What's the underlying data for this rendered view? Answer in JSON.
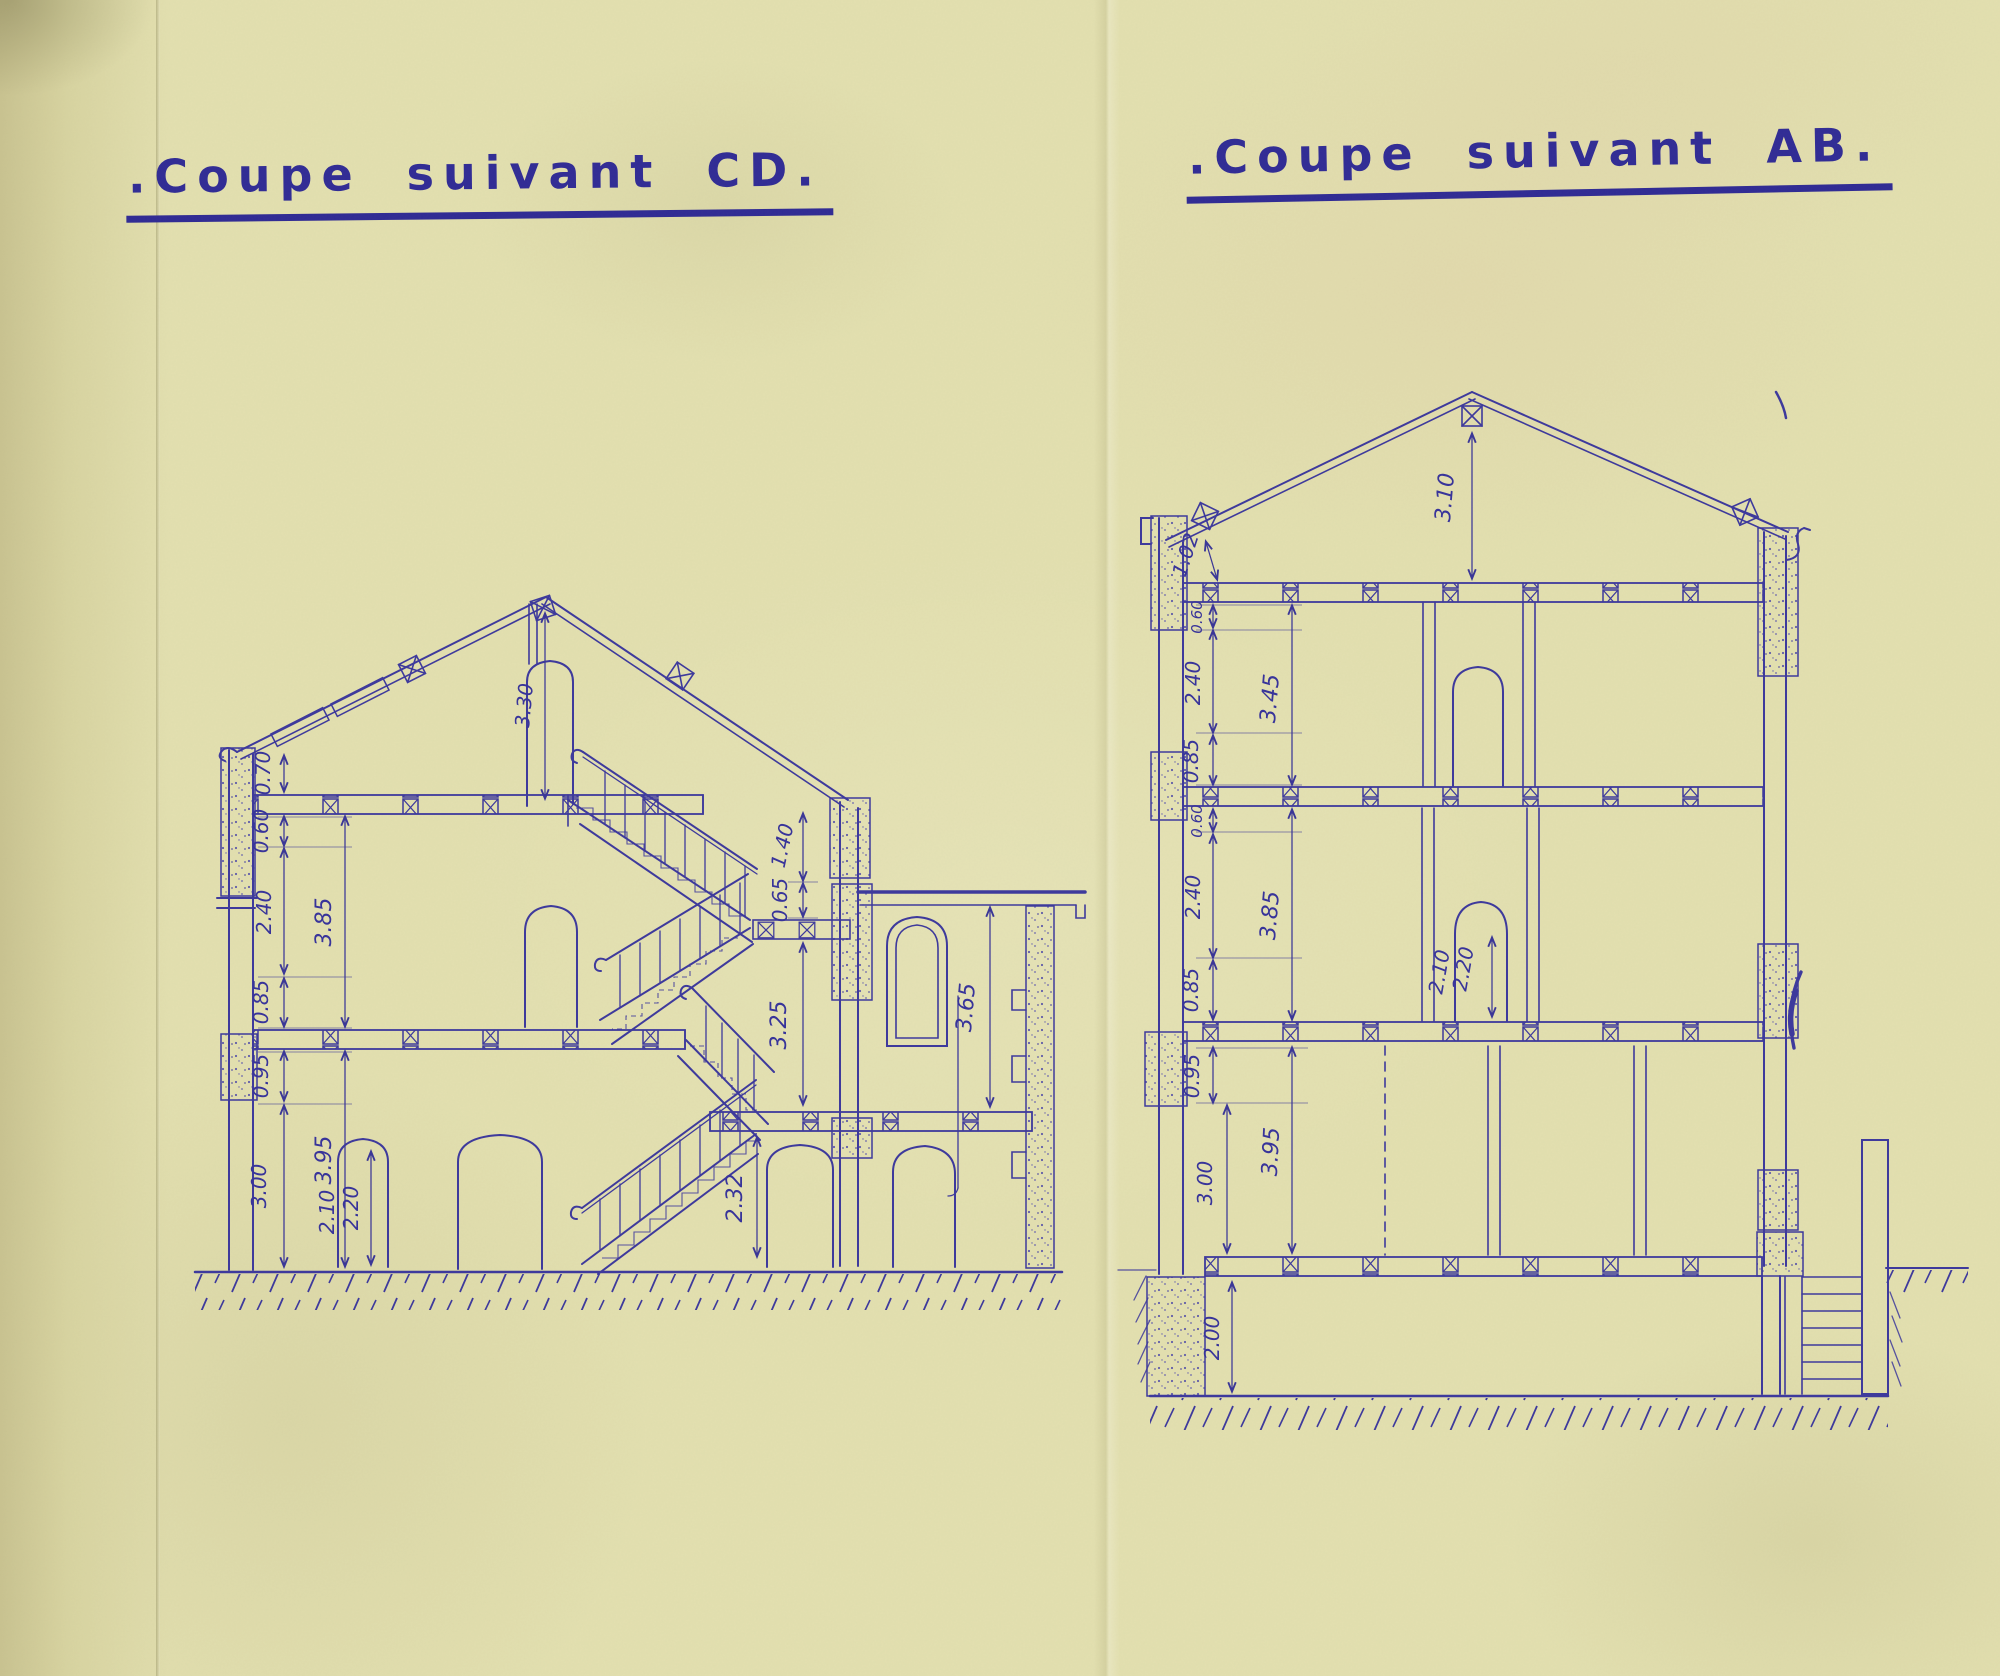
{
  "paper": {
    "background": "#e3e0b0",
    "ink": "#3b3797"
  },
  "cd": {
    "title": ".Coupe suivant CD.",
    "dims": {
      "eave_to_attic": "0.70",
      "attic_joist": "0.60",
      "second_clear": "2.40",
      "second_total": "3.85",
      "second_sill": "0.85",
      "first_joist": "0.95",
      "first_clear": "3.00",
      "first_total": "3.95",
      "door_clear": "2.10",
      "door_arch": "2.20",
      "attic_ridge": "3.30",
      "stair_head": "1.40",
      "stair_landing": "0.65",
      "stair_well": "3.25",
      "annex_storey": "3.65",
      "stair_rise": "2.32"
    }
  },
  "ab": {
    "title": ".Coupe suivant AB.",
    "dims": {
      "ridge": "3.10",
      "eave": "1.02",
      "attic_joist": "0.60",
      "attic_clear": "2.40",
      "attic_total": "3.45",
      "attic_sill": "0.85",
      "second_joist": "0.60",
      "second_clear": "2.40",
      "second_total": "3.85",
      "second_sill": "0.85",
      "first_joist": "0.95",
      "first_clear": "3.00",
      "first_total": "3.95",
      "door_clear": "2.10",
      "door_arch": "2.20",
      "basement": "2.00"
    }
  }
}
